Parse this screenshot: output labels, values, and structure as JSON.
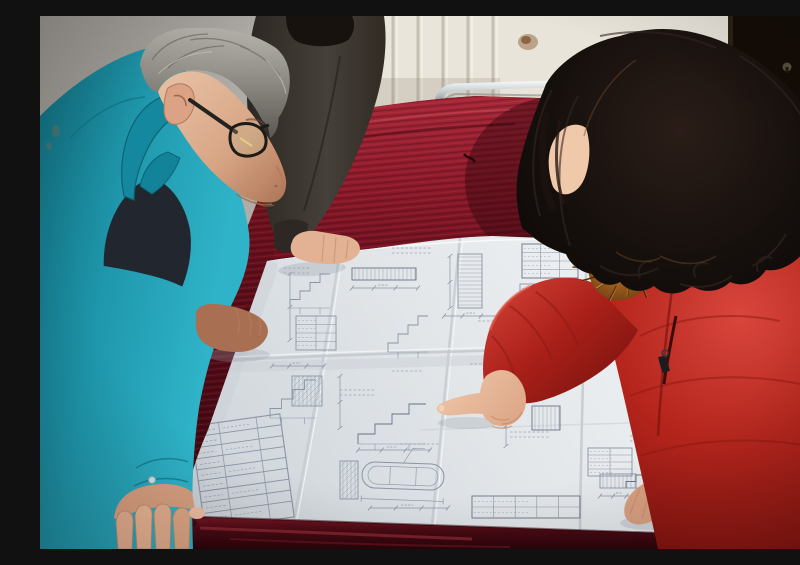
{
  "scene": {
    "type": "photograph",
    "caption": "Two workers lean over a large folded engineering blueprint spread on a dark red velvet-covered table. A woman in a red parka with an orange fur-trimmed hood points at a construction detail while a gray-haired man in a teal work jacket and dark-rimmed glasses studies the sheet. A third person in dark clothes rests a hand on the drawing. Behind them: a gray wall, a white radiator, a stained wall panel, a dark door and a chrome-framed red chair.",
    "people": [
      {
        "id": "man-teal",
        "description": "middle-aged man, gray hair, dark-rimmed glasses, bright teal work jacket over dark shirt, both hands on table edge and blueprint"
      },
      {
        "id": "woman-red",
        "description": "woman with long dark wavy hair, red quilted parka with orange fur hood trim, pointing at blueprint with right index finger, left hand resting on sheet"
      },
      {
        "id": "person-dark",
        "description": "partially visible person in dark gray-brown jacket, black hair, hand resting flat on top of blueprint"
      }
    ],
    "objects": [
      {
        "id": "blueprint",
        "description": "large folded white construction drawing sheet with dense stair details, dimension lines, hatched sections, small data tables, a rotated title block and a stadium-shaped detail"
      },
      {
        "id": "table",
        "description": "large table draped in dark crimson velvet"
      },
      {
        "id": "chair",
        "description": "chrome tube framed chair with red upholstery behind the table"
      },
      {
        "id": "radiator",
        "description": "white vertical-fin radiator panel on back wall"
      },
      {
        "id": "door",
        "description": "very dark brown door at right with small metal keyhole plate"
      },
      {
        "id": "wall-stain",
        "description": "brown stain on warm white wall"
      }
    ]
  },
  "palette": {
    "teal_jacket": "#1f97ac",
    "teal_dark": "#0f6878",
    "red_coat": "#b5251c",
    "fur_trim": "#9c5c1c",
    "velvet": "#5c0e1a",
    "velvet_bright": "#8e1a2a",
    "paper": "#e3e7ea",
    "blueprint_lines": "#8a94a4",
    "gray_wall": "#a9a6a2",
    "warm_wall": "#e8e4da",
    "door": "#140d06",
    "hair_woman": "#16100d",
    "hair_man": "#8e8b85",
    "skin": "#d9a081",
    "chrome": "#b9c3c6",
    "chair_red": "#9c1f2c",
    "dark_jacket": "#46403a",
    "inner_shirt": "#22262e"
  }
}
